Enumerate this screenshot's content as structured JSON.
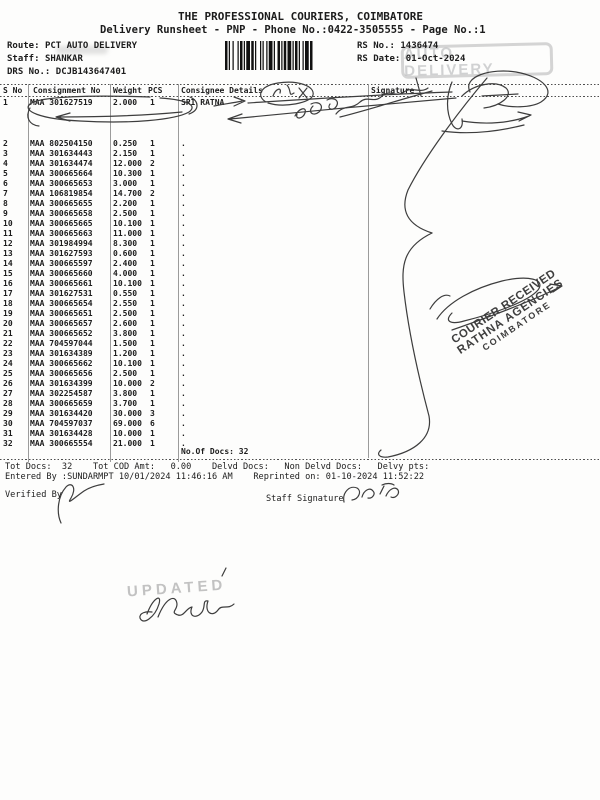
{
  "header": {
    "company": "THE PROFESSIONAL COURIERS, COIMBATORE",
    "runsheet_line": "Delivery Runsheet - PNP - Phone No.:0422-3505555 - Page No.:1",
    "route_label": "Route:",
    "route_value": "PCT AUTO DELIVERY",
    "staff_label": "Staff:",
    "staff_value": "SHANKAR",
    "drs_label": "DRS No.:",
    "drs_value": "DCJB143647401",
    "rs_no_label": "RS No.:",
    "rs_no_value": "1436474",
    "rs_date_label": "RS Date:",
    "rs_date_value": "01-Oct-2024"
  },
  "stamps": {
    "auto_delivery": "AUTO DELIVERY",
    "updated": "UPDATED",
    "courier_received_line1": "COURIER RECEIVED",
    "courier_received_line2": "RATHNA AGENCIES",
    "courier_received_line3": "COIMBATORE"
  },
  "table": {
    "headers": {
      "sno": "S No",
      "consignment": "Consignment No",
      "weight": "Weight",
      "pcs": "PCS",
      "consignee": "Consignee Details",
      "signature": "Signature"
    },
    "rows": [
      {
        "sno": "1",
        "consignment": "MAA 301627519",
        "weight": "2.000",
        "pcs": "1",
        "consignee": "SRI RATNA"
      },
      {
        "sno": "2",
        "consignment": "MAA 802504150",
        "weight": "0.250",
        "pcs": "1",
        "consignee": "."
      },
      {
        "sno": "3",
        "consignment": "MAA 301634443",
        "weight": "2.150",
        "pcs": "1",
        "consignee": "."
      },
      {
        "sno": "4",
        "consignment": "MAA 301634474",
        "weight": "12.000",
        "pcs": "2",
        "consignee": "."
      },
      {
        "sno": "5",
        "consignment": "MAA 300665664",
        "weight": "10.300",
        "pcs": "1",
        "consignee": "."
      },
      {
        "sno": "6",
        "consignment": "MAA 300665653",
        "weight": "3.000",
        "pcs": "1",
        "consignee": "."
      },
      {
        "sno": "7",
        "consignment": "MAA 106819854",
        "weight": "14.700",
        "pcs": "2",
        "consignee": "."
      },
      {
        "sno": "8",
        "consignment": "MAA 300665655",
        "weight": "2.200",
        "pcs": "1",
        "consignee": "."
      },
      {
        "sno": "9",
        "consignment": "MAA 300665658",
        "weight": "2.500",
        "pcs": "1",
        "consignee": "."
      },
      {
        "sno": "10",
        "consignment": "MAA 300665665",
        "weight": "10.100",
        "pcs": "1",
        "consignee": "."
      },
      {
        "sno": "11",
        "consignment": "MAA 300665663",
        "weight": "11.000",
        "pcs": "1",
        "consignee": "."
      },
      {
        "sno": "12",
        "consignment": "MAA 301984994",
        "weight": "8.300",
        "pcs": "1",
        "consignee": "."
      },
      {
        "sno": "13",
        "consignment": "MAA 301627593",
        "weight": "0.600",
        "pcs": "1",
        "consignee": "."
      },
      {
        "sno": "14",
        "consignment": "MAA 300665597",
        "weight": "2.400",
        "pcs": "1",
        "consignee": "."
      },
      {
        "sno": "15",
        "consignment": "MAA 300665660",
        "weight": "4.000",
        "pcs": "1",
        "consignee": "."
      },
      {
        "sno": "16",
        "consignment": "MAA 300665661",
        "weight": "10.100",
        "pcs": "1",
        "consignee": "."
      },
      {
        "sno": "17",
        "consignment": "MAA 301627531",
        "weight": "0.550",
        "pcs": "1",
        "consignee": "."
      },
      {
        "sno": "18",
        "consignment": "MAA 300665654",
        "weight": "2.550",
        "pcs": "1",
        "consignee": "."
      },
      {
        "sno": "19",
        "consignment": "MAA 300665651",
        "weight": "2.500",
        "pcs": "1",
        "consignee": "."
      },
      {
        "sno": "20",
        "consignment": "MAA 300665657",
        "weight": "2.600",
        "pcs": "1",
        "consignee": "."
      },
      {
        "sno": "21",
        "consignment": "MAA 300665652",
        "weight": "3.800",
        "pcs": "1",
        "consignee": "."
      },
      {
        "sno": "22",
        "consignment": "MAA 704597044",
        "weight": "1.500",
        "pcs": "1",
        "consignee": "."
      },
      {
        "sno": "23",
        "consignment": "MAA 301634389",
        "weight": "1.200",
        "pcs": "1",
        "consignee": "."
      },
      {
        "sno": "24",
        "consignment": "MAA 300665662",
        "weight": "10.100",
        "pcs": "1",
        "consignee": "."
      },
      {
        "sno": "25",
        "consignment": "MAA 300665656",
        "weight": "2.500",
        "pcs": "1",
        "consignee": "."
      },
      {
        "sno": "26",
        "consignment": "MAA 301634399",
        "weight": "10.000",
        "pcs": "2",
        "consignee": "."
      },
      {
        "sno": "27",
        "consignment": "MAA 302254587",
        "weight": "3.800",
        "pcs": "1",
        "consignee": "."
      },
      {
        "sno": "28",
        "consignment": "MAA 300665659",
        "weight": "3.700",
        "pcs": "1",
        "consignee": "."
      },
      {
        "sno": "29",
        "consignment": "MAA 301634420",
        "weight": "30.000",
        "pcs": "3",
        "consignee": "."
      },
      {
        "sno": "30",
        "consignment": "MAA 704597037",
        "weight": "69.000",
        "pcs": "6",
        "consignee": "."
      },
      {
        "sno": "31",
        "consignment": "MAA 301634428",
        "weight": "10.000",
        "pcs": "1",
        "consignee": "."
      },
      {
        "sno": "32",
        "consignment": "MAA 300665554",
        "weight": "21.000",
        "pcs": "1",
        "consignee": "."
      }
    ],
    "no_of_docs": "No.Of Docs: 32"
  },
  "footer": {
    "totals_line": "Tot Docs:  32    Tot COD Amt:   0.00    Delvd Docs:   Non Delvd Docs:   Delvy pts:",
    "entered_line": "Entered By :SUNDARMPT 10/01/2024 11:46:16 AM    Reprinted on: 01-10-2024 11:52:22",
    "verified_by_label": "Verified By",
    "staff_signature_label": "Staff Signature"
  },
  "colors": {
    "ink": "#1c1c1c",
    "pen": "#3d3d3d",
    "stamp_gray": "#b4b4b4",
    "stamp_dark": "#3e3e3e"
  }
}
